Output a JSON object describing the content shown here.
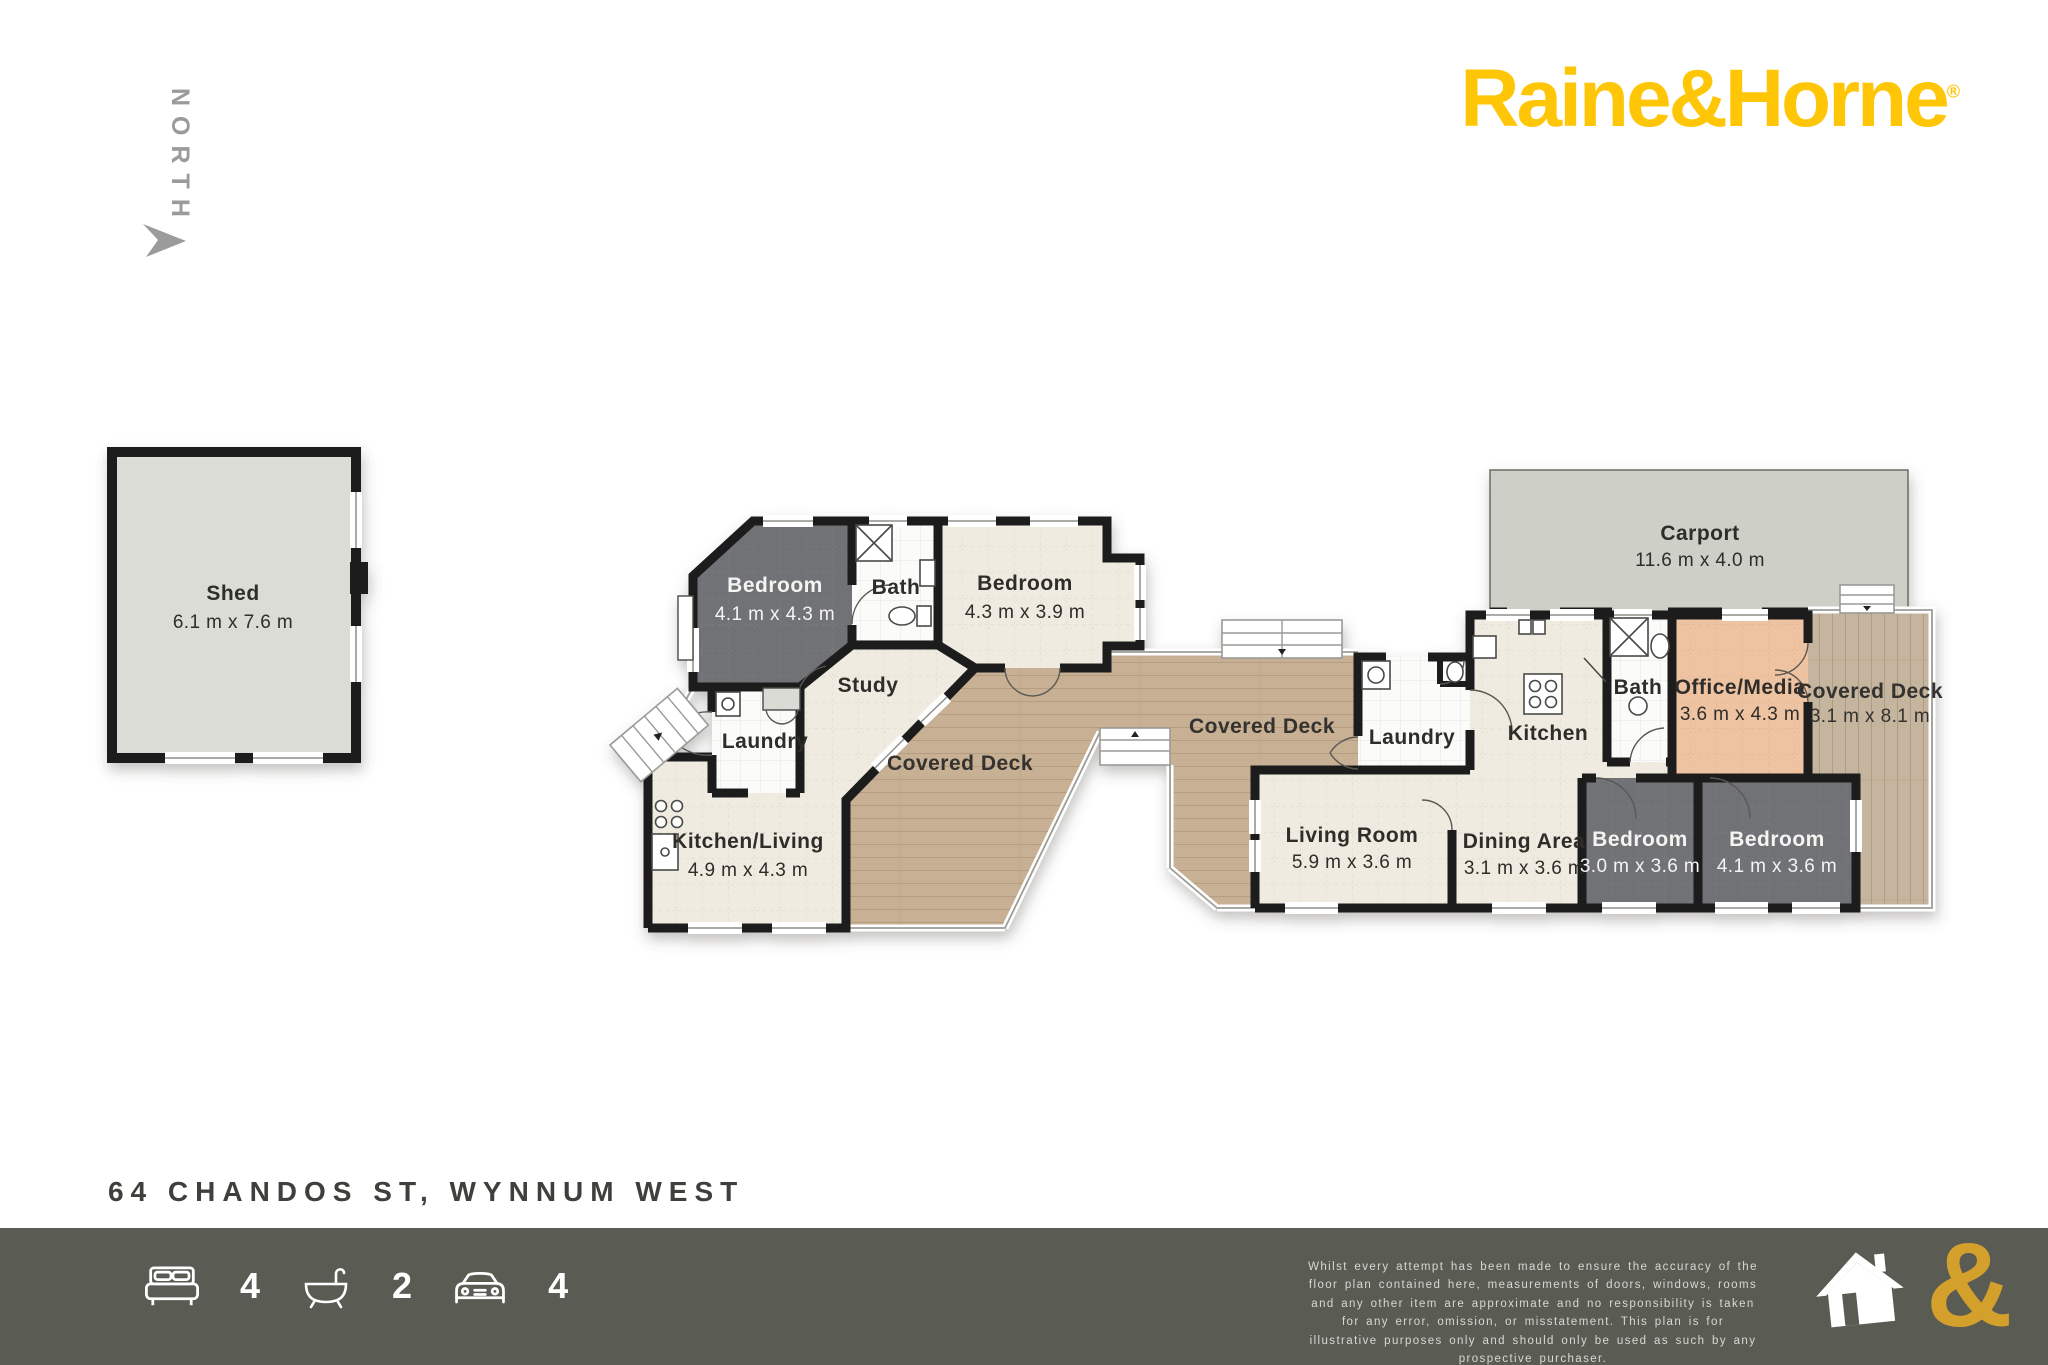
{
  "compass": {
    "label": "NORTH"
  },
  "brand": {
    "logo": "Raine&Horne",
    "mark": "®"
  },
  "floorplan": {
    "shed": {
      "name": "Shed",
      "dims": "6.1 m x 7.6 m"
    },
    "carport": {
      "name": "Carport",
      "dims": "11.6 m x 4.0 m"
    },
    "bedroom_1": {
      "name": "Bedroom",
      "dims": "4.1 m x 4.3 m"
    },
    "bath_1": {
      "name": "Bath"
    },
    "bedroom_2": {
      "name": "Bedroom",
      "dims": "4.3 m x 3.9 m"
    },
    "study": {
      "name": "Study"
    },
    "laundry_1": {
      "name": "Laundry"
    },
    "kitchen_living": {
      "name": "Kitchen/Living",
      "dims": "4.9 m x 4.3 m"
    },
    "deck_left": {
      "name": "Covered Deck"
    },
    "deck_middle": {
      "name": "Covered Deck"
    },
    "laundry_2": {
      "name": "Laundry"
    },
    "kitchen": {
      "name": "Kitchen"
    },
    "bath_2": {
      "name": "Bath"
    },
    "office_media": {
      "name": "Office/Media",
      "dims": "3.6 m x 4.3 m"
    },
    "deck_right": {
      "name": "Covered Deck",
      "dims": "3.1 m x 8.1 m"
    },
    "living_room": {
      "name": "Living Room",
      "dims": "5.9 m x 3.6 m"
    },
    "dining_area": {
      "name": "Dining Area",
      "dims": "3.1 m x 3.6 m"
    },
    "bedroom_3": {
      "name": "Bedroom",
      "dims": "3.0 m x 3.6 m"
    },
    "bedroom_4": {
      "name": "Bedroom",
      "dims": "4.1 m x 3.6 m"
    }
  },
  "address": "64 CHANDOS ST, WYNNUM WEST",
  "footer": {
    "beds": "4",
    "baths": "2",
    "cars": "4",
    "ampersand": "&",
    "disclaimer": "Whilst every attempt has been made to ensure the accuracy of the floor plan contained here, measurements of doors, windows, rooms and any other item are approximate and no responsibility is taken for any error, omission, or misstatement. This plan is for illustrative purposes only and should only be used as such by any prospective purchaser."
  },
  "colors": {
    "logo_gold": "#FFC608",
    "footer_bar": "#5A5B53",
    "footer_ampersand": "#D4A02C",
    "wall": "#1B1B1B",
    "room_cream": "#EFEBE1",
    "room_dark": "#6F7276",
    "deck_wood": "#C8B095",
    "office_peach": "#EEC3A2",
    "carport_gray": "#CED0C8",
    "shed_gray": "#DCDCD6"
  }
}
